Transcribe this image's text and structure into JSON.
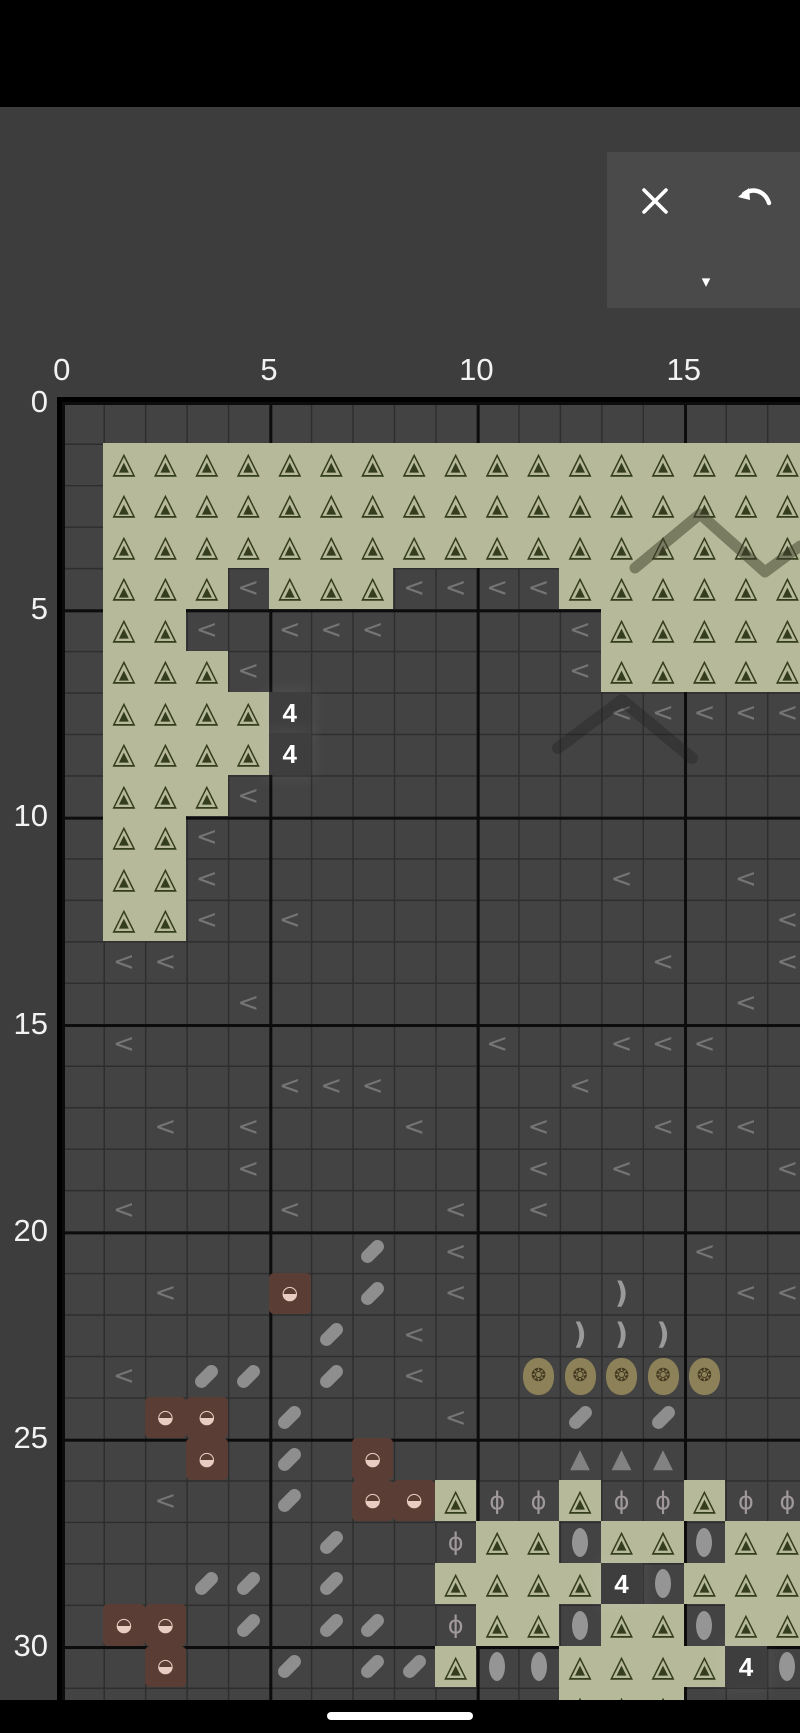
{
  "screen": {
    "width": 800,
    "height": 1733,
    "bg": "#3d3d3d"
  },
  "status_bar": {
    "color": "#000000"
  },
  "toolbar": {
    "bg": "#4a4a4a",
    "buttons": [
      {
        "name": "close",
        "icon": "x-icon"
      },
      {
        "name": "undo",
        "icon": "undo-arrow-icon"
      },
      {
        "name": "collapse",
        "icon": "caret-down-icon",
        "glyph": "▾"
      }
    ]
  },
  "axis": {
    "col_labels": [
      {
        "text": "0",
        "cell": 0
      },
      {
        "text": "5",
        "cell": 5
      },
      {
        "text": "10",
        "cell": 10
      },
      {
        "text": "15",
        "cell": 15
      }
    ],
    "row_labels": [
      {
        "text": "0",
        "cell": 0
      },
      {
        "text": "5",
        "cell": 5
      },
      {
        "text": "10",
        "cell": 10
      },
      {
        "text": "15",
        "cell": 15
      },
      {
        "text": "20",
        "cell": 20
      },
      {
        "text": "25",
        "cell": 25
      },
      {
        "text": "30",
        "cell": 30
      }
    ]
  },
  "grid": {
    "origin": {
      "x": 61.7,
      "y": 401.7
    },
    "cell_size": 41.47,
    "cols": 18,
    "rows": 32,
    "major_every": 5,
    "count_text": "4",
    "cells": [
      {
        "t": "tree",
        "r": 1,
        "c": [
          1,
          17
        ]
      },
      {
        "t": "tree",
        "r": 2,
        "c": [
          1,
          17
        ]
      },
      {
        "t": "tree",
        "r": 3,
        "c": [
          1,
          17
        ]
      },
      {
        "t": "tree",
        "r": 4,
        "c": [
          1,
          3
        ]
      },
      {
        "t": "lt",
        "r": 4,
        "c": [
          4
        ]
      },
      {
        "t": "tree",
        "r": 4,
        "c": [
          5,
          7
        ]
      },
      {
        "t": "lt",
        "r": 4,
        "c": [
          8,
          11
        ]
      },
      {
        "t": "tree",
        "r": 4,
        "c": [
          12,
          17
        ]
      },
      {
        "t": "tree",
        "r": 5,
        "c": [
          1,
          2
        ]
      },
      {
        "t": "lt",
        "r": 5,
        "c": [
          3
        ]
      },
      {
        "t": "lt",
        "r": 5,
        "c": [
          5,
          7
        ]
      },
      {
        "t": "lt",
        "r": 5,
        "c": [
          12
        ]
      },
      {
        "t": "tree",
        "r": 5,
        "c": [
          13,
          17
        ]
      },
      {
        "t": "tree",
        "r": 6,
        "c": [
          1,
          3
        ]
      },
      {
        "t": "lt",
        "r": 6,
        "c": [
          4
        ]
      },
      {
        "t": "lt",
        "r": 6,
        "c": [
          12
        ]
      },
      {
        "t": "tree",
        "r": 6,
        "c": [
          13,
          17
        ]
      },
      {
        "t": "tree",
        "r": 7,
        "c": [
          1,
          4
        ]
      },
      {
        "t": "count",
        "r": 7,
        "c": [
          5
        ]
      },
      {
        "t": "lt",
        "r": 7,
        "c": [
          13,
          17
        ]
      },
      {
        "t": "tree",
        "r": 8,
        "c": [
          1,
          4
        ]
      },
      {
        "t": "count",
        "r": 8,
        "c": [
          5
        ]
      },
      {
        "t": "tree",
        "r": 9,
        "c": [
          1,
          3
        ]
      },
      {
        "t": "lt",
        "r": 9,
        "c": [
          4
        ]
      },
      {
        "t": "tree",
        "r": 10,
        "c": [
          1,
          2
        ]
      },
      {
        "t": "lt",
        "r": 10,
        "c": [
          3
        ]
      },
      {
        "t": "tree",
        "r": 11,
        "c": [
          1,
          2
        ]
      },
      {
        "t": "lt",
        "r": 11,
        "c": [
          3
        ]
      },
      {
        "t": "lt",
        "r": 11,
        "c": [
          13
        ]
      },
      {
        "t": "lt",
        "r": 11,
        "c": [
          16
        ]
      },
      {
        "t": "tree",
        "r": 12,
        "c": [
          1,
          2
        ]
      },
      {
        "t": "lt",
        "r": 12,
        "c": [
          3
        ]
      },
      {
        "t": "lt",
        "r": 12,
        "c": [
          5
        ]
      },
      {
        "t": "lt",
        "r": 12,
        "c": [
          17
        ]
      },
      {
        "t": "lt",
        "r": 13,
        "c": [
          1,
          2
        ]
      },
      {
        "t": "lt",
        "r": 13,
        "c": [
          14
        ]
      },
      {
        "t": "lt",
        "r": 13,
        "c": [
          17
        ]
      },
      {
        "t": "lt",
        "r": 14,
        "c": [
          4
        ]
      },
      {
        "t": "lt",
        "r": 14,
        "c": [
          16
        ]
      },
      {
        "t": "lt",
        "r": 15,
        "c": [
          1
        ]
      },
      {
        "t": "lt",
        "r": 15,
        "c": [
          10
        ]
      },
      {
        "t": "lt",
        "r": 15,
        "c": [
          13,
          15
        ]
      },
      {
        "t": "lt",
        "r": 16,
        "c": [
          5,
          7
        ]
      },
      {
        "t": "lt",
        "r": 16,
        "c": [
          12
        ]
      },
      {
        "t": "lt",
        "r": 17,
        "c": [
          2
        ]
      },
      {
        "t": "lt",
        "r": 17,
        "c": [
          4
        ]
      },
      {
        "t": "lt",
        "r": 17,
        "c": [
          8
        ]
      },
      {
        "t": "lt",
        "r": 17,
        "c": [
          11
        ]
      },
      {
        "t": "lt",
        "r": 17,
        "c": [
          14,
          16
        ]
      },
      {
        "t": "lt",
        "r": 18,
        "c": [
          4
        ]
      },
      {
        "t": "lt",
        "r": 18,
        "c": [
          11
        ]
      },
      {
        "t": "lt",
        "r": 18,
        "c": [
          13
        ]
      },
      {
        "t": "lt",
        "r": 18,
        "c": [
          17
        ]
      },
      {
        "t": "lt",
        "r": 19,
        "c": [
          1
        ]
      },
      {
        "t": "lt",
        "r": 19,
        "c": [
          5
        ]
      },
      {
        "t": "lt",
        "r": 19,
        "c": [
          9
        ]
      },
      {
        "t": "lt",
        "r": 19,
        "c": [
          11
        ]
      },
      {
        "t": "pill",
        "r": 20,
        "c": [
          7
        ]
      },
      {
        "t": "lt",
        "r": 20,
        "c": [
          9
        ]
      },
      {
        "t": "lt",
        "r": 20,
        "c": [
          15
        ]
      },
      {
        "t": "lt",
        "r": 21,
        "c": [
          2
        ]
      },
      {
        "t": "basket",
        "r": 21,
        "c": [
          5
        ]
      },
      {
        "t": "pill",
        "r": 21,
        "c": [
          7
        ]
      },
      {
        "t": "lt",
        "r": 21,
        "c": [
          9
        ]
      },
      {
        "t": "moon",
        "r": 21,
        "c": [
          13
        ]
      },
      {
        "t": "lt",
        "r": 21,
        "c": [
          16,
          17
        ]
      },
      {
        "t": "pill",
        "r": 22,
        "c": [
          6
        ]
      },
      {
        "t": "lt",
        "r": 22,
        "c": [
          8
        ]
      },
      {
        "t": "moon",
        "r": 22,
        "c": [
          12,
          14
        ]
      },
      {
        "t": "lt",
        "r": 23,
        "c": [
          1
        ]
      },
      {
        "t": "pill",
        "r": 23,
        "c": [
          3,
          4
        ]
      },
      {
        "t": "pill",
        "r": 23,
        "c": [
          6
        ]
      },
      {
        "t": "lt",
        "r": 23,
        "c": [
          8
        ]
      },
      {
        "t": "flower",
        "r": 23,
        "c": [
          11,
          15
        ]
      },
      {
        "t": "basket",
        "r": 24,
        "c": [
          2,
          3
        ]
      },
      {
        "t": "pill",
        "r": 24,
        "c": [
          5
        ]
      },
      {
        "t": "lt",
        "r": 24,
        "c": [
          9
        ]
      },
      {
        "t": "pill",
        "r": 24,
        "c": [
          12
        ]
      },
      {
        "t": "pill",
        "r": 24,
        "c": [
          14
        ]
      },
      {
        "t": "basket",
        "r": 25,
        "c": [
          3
        ]
      },
      {
        "t": "pill",
        "r": 25,
        "c": [
          5
        ]
      },
      {
        "t": "basket",
        "r": 25,
        "c": [
          7
        ]
      },
      {
        "t": "gtri",
        "r": 25,
        "c": [
          12,
          14
        ]
      },
      {
        "t": "lt",
        "r": 26,
        "c": [
          2
        ]
      },
      {
        "t": "pill",
        "r": 26,
        "c": [
          5
        ]
      },
      {
        "t": "basket",
        "r": 26,
        "c": [
          7,
          8
        ]
      },
      {
        "t": "tree",
        "r": 26,
        "c": [
          9
        ]
      },
      {
        "t": "phi",
        "r": 26,
        "c": [
          10,
          11
        ]
      },
      {
        "t": "tree",
        "r": 26,
        "c": [
          12
        ]
      },
      {
        "t": "phi",
        "r": 26,
        "c": [
          13,
          14
        ]
      },
      {
        "t": "tree",
        "r": 26,
        "c": [
          15
        ]
      },
      {
        "t": "phi",
        "r": 26,
        "c": [
          16,
          17
        ]
      },
      {
        "t": "pill",
        "r": 27,
        "c": [
          6
        ]
      },
      {
        "t": "phi",
        "r": 27,
        "c": [
          9
        ]
      },
      {
        "t": "tree",
        "r": 27,
        "c": [
          10,
          11
        ]
      },
      {
        "t": "oval",
        "r": 27,
        "c": [
          12
        ]
      },
      {
        "t": "tree",
        "r": 27,
        "c": [
          13,
          14
        ]
      },
      {
        "t": "oval",
        "r": 27,
        "c": [
          15
        ]
      },
      {
        "t": "tree",
        "r": 27,
        "c": [
          16,
          17
        ]
      },
      {
        "t": "pill",
        "r": 28,
        "c": [
          3,
          4
        ]
      },
      {
        "t": "pill",
        "r": 28,
        "c": [
          6
        ]
      },
      {
        "t": "tree",
        "r": 28,
        "c": [
          9,
          12
        ]
      },
      {
        "t": "count",
        "r": 28,
        "c": [
          13
        ]
      },
      {
        "t": "oval",
        "r": 28,
        "c": [
          14
        ]
      },
      {
        "t": "tree",
        "r": 28,
        "c": [
          15,
          17
        ]
      },
      {
        "t": "basket",
        "r": 29,
        "c": [
          1,
          2
        ]
      },
      {
        "t": "pill",
        "r": 29,
        "c": [
          4
        ]
      },
      {
        "t": "pill",
        "r": 29,
        "c": [
          6,
          7
        ]
      },
      {
        "t": "phi",
        "r": 29,
        "c": [
          9
        ]
      },
      {
        "t": "tree",
        "r": 29,
        "c": [
          10,
          11
        ]
      },
      {
        "t": "oval",
        "r": 29,
        "c": [
          12
        ]
      },
      {
        "t": "tree",
        "r": 29,
        "c": [
          13,
          14
        ]
      },
      {
        "t": "oval",
        "r": 29,
        "c": [
          15
        ]
      },
      {
        "t": "tree",
        "r": 29,
        "c": [
          16,
          17
        ]
      },
      {
        "t": "basket",
        "r": 30,
        "c": [
          2
        ]
      },
      {
        "t": "pill",
        "r": 30,
        "c": [
          5
        ]
      },
      {
        "t": "pill",
        "r": 30,
        "c": [
          7,
          8
        ]
      },
      {
        "t": "tree",
        "r": 30,
        "c": [
          9
        ]
      },
      {
        "t": "oval",
        "r": 30,
        "c": [
          10,
          11
        ]
      },
      {
        "t": "tree",
        "r": 30,
        "c": [
          12,
          15
        ]
      },
      {
        "t": "count",
        "r": 30,
        "c": [
          16
        ]
      },
      {
        "t": "oval",
        "r": 30,
        "c": [
          17
        ]
      },
      {
        "t": "tree",
        "r": 31,
        "c": [
          12,
          14
        ]
      }
    ]
  },
  "symbols": {
    "glyphs": {
      "tree_outline": "△",
      "tree_fill": "▲",
      "lt": "<",
      "basket": "◒",
      "moon": ")",
      "flower": "❂",
      "gtri": "▲",
      "phi": "ϕ"
    },
    "colors": {
      "tree_bg": "#b7b99b",
      "tree_symbol": "#343d1e",
      "lt": "#828282",
      "count_bg": "#3e3e3e",
      "count_text": "#ffffff",
      "pill": "#8e8e8e",
      "basket_bg": "#5a3e35",
      "basket_symbol": "#e7cdc2",
      "moon": "#9a9a9a",
      "flower_bg": "#8c8158",
      "flower_symbol": "#443a21",
      "gray_triangle": "#828282",
      "phi": "#a0989a",
      "oval": "#959595",
      "grid_bg": "#434343",
      "grid_line": "#2e2e2e",
      "grid_major_line": "#0c0c0c",
      "page_bg": "#3d3d3d",
      "label_text": "#f2f2f2"
    }
  },
  "overlays": [
    {
      "name": "backstitch-zigzag-upper",
      "points": "635,568 700,514 765,572 800,546",
      "color": "rgba(62,64,42,0.5)",
      "width": 11
    },
    {
      "name": "backstitch-zigzag-lower",
      "points": "558,748 622,700 692,758",
      "color": "rgba(25,25,25,0.3)",
      "width": 12
    }
  ],
  "home_indicator": {
    "color": "#ffffff"
  }
}
